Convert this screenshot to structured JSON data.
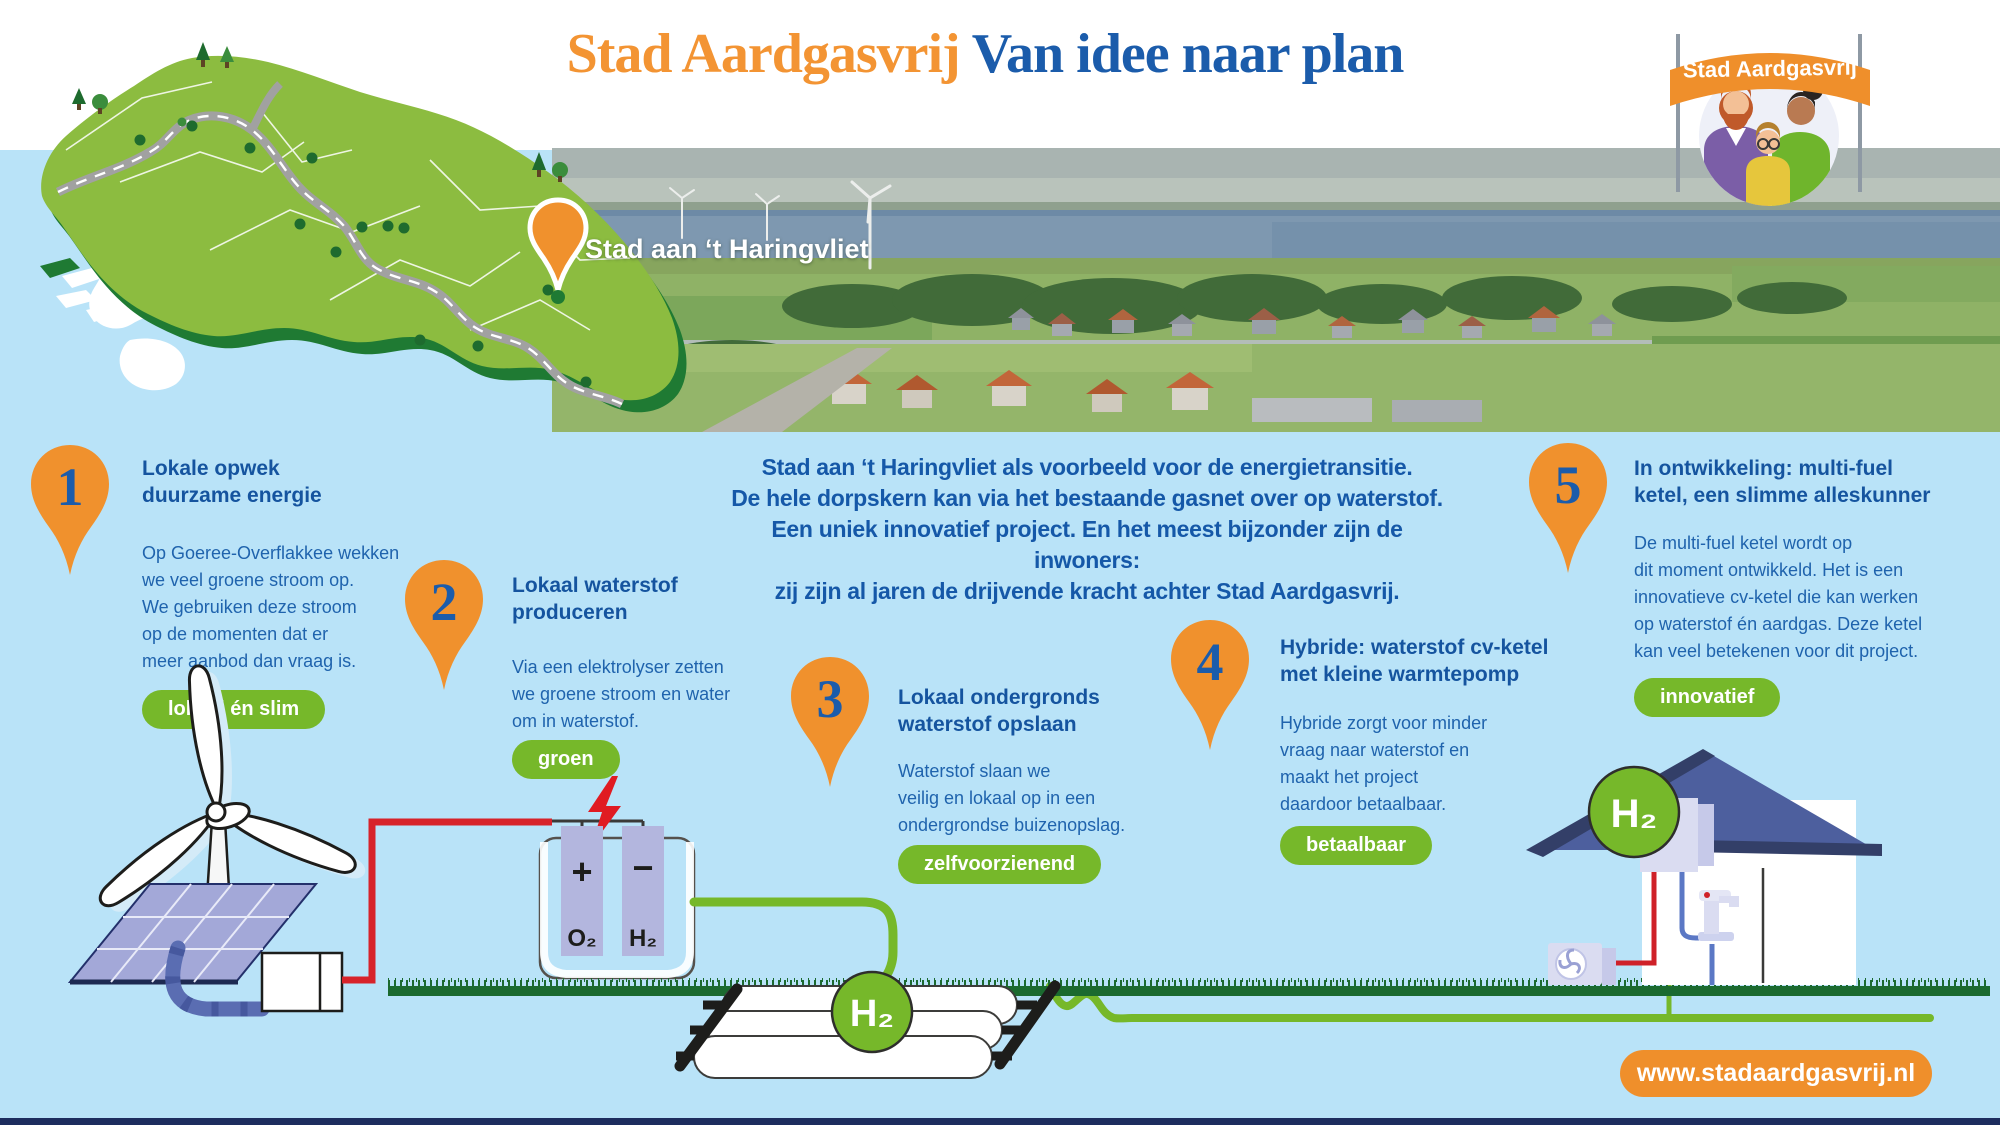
{
  "title": {
    "brand": "Stad Aardgasvrij",
    "subtitle": "Van idee naar plan"
  },
  "logo": {
    "banner_text": "Stad Aardgasvrij"
  },
  "photo": {
    "pin_label": "Stad aan ‘t Haringvliet"
  },
  "intro": {
    "text": "Stad aan ‘t Haringvliet als voorbeeld voor de energietransitie.\nDe hele dorpskern kan via het bestaande gasnet over op waterstof.\nEen uniek innovatief project. En het meest bijzonder zijn de inwoners:\nzij zijn al jaren de drijvende kracht achter Stad Aardgasvrij."
  },
  "steps": [
    {
      "number": "1",
      "title": "Lokale opwek\nduurzame energie",
      "body": "Op Goeree-Overflakkee wekken\nwe veel groene stroom op.\nWe gebruiken deze stroom\nop de momenten dat er\nmeer aanbod dan vraag is.",
      "badge": "lokaal én slim"
    },
    {
      "number": "2",
      "title": "Lokaal waterstof\nproduceren",
      "body": "Via een elektrolyser zetten\nwe groene stroom en water\nom in waterstof.",
      "badge": "groen"
    },
    {
      "number": "3",
      "title": "Lokaal ondergronds\nwaterstof opslaan",
      "body": "Waterstof slaan we\nveilig en lokaal op in een\nondergrondse buizenopslag.",
      "badge": "zelfvoorzienend"
    },
    {
      "number": "4",
      "title": "Hybride: waterstof cv-ketel\nmet kleine warmtepomp",
      "body": "Hybride zorgt voor minder\nvraag naar waterstof en\nmaakt het project\ndaardoor betaalbaar.",
      "badge": "betaalbaar"
    },
    {
      "number": "5",
      "title": "In ontwikkeling: multi-fuel\nketel, een slimme alleskunner",
      "body": "De multi-fuel ketel wordt op\ndit moment ontwikkeld. Het is een\ninnovatieve cv-ketel die kan werken\nop waterstof én aardgas. Deze ketel\nkan veel betekenen voor dit project.",
      "badge": "innovatief"
    }
  ],
  "diagram": {
    "electrolyser": {
      "plus": "+",
      "minus": "−",
      "o2": "O₂",
      "h2": "H₂"
    },
    "storage_h2": "H₂",
    "house_h2": "H₂"
  },
  "footer": {
    "website": "www.stadaardgasvrij.nl"
  },
  "colors": {
    "accent_orange": "#f0912d",
    "brand_blue": "#1b5cab",
    "badge_green": "#76b82a",
    "background": "#b9e3f8"
  }
}
